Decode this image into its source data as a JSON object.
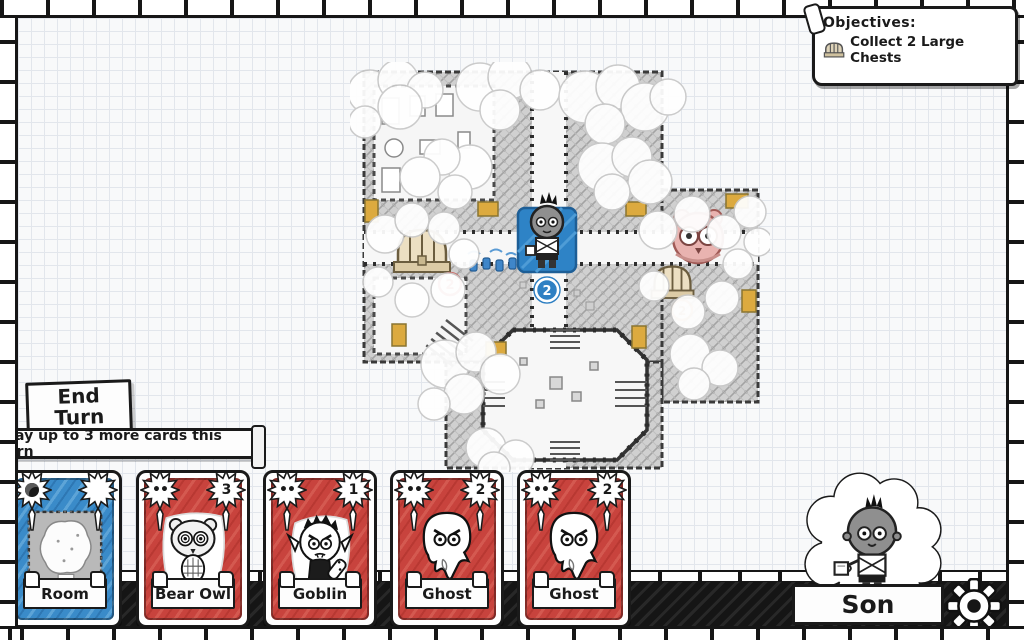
{
  "objectives": {
    "title": "Objectives:",
    "items": [
      {
        "icon": "large-chest-icon",
        "label": "Collect 2 Large Chests"
      }
    ]
  },
  "turn": {
    "end_turn_line1": "End",
    "end_turn_line2": "Turn",
    "banner_text": "Play up to 3 more cards this turn"
  },
  "hand": {
    "cards": [
      {
        "name": "Room",
        "kind": "room",
        "cost": "",
        "color": "#3a8bc9"
      },
      {
        "name": "Bear Owl",
        "kind": "monster",
        "cost": "3",
        "color": "#c8433d"
      },
      {
        "name": "Goblin",
        "kind": "monster",
        "cost": "1",
        "color": "#c8433d"
      },
      {
        "name": "Ghost",
        "kind": "monster",
        "cost": "2",
        "color": "#c8433d"
      },
      {
        "name": "Ghost",
        "kind": "monster",
        "cost": "2",
        "color": "#c8433d"
      }
    ]
  },
  "map": {
    "player_move_badge": "2",
    "left_chest_badge": "2",
    "right_chest_badge": "2"
  },
  "hero": {
    "name": "Son"
  },
  "icons": {
    "monster_attack_dots": "••",
    "objective_chest": "large-chest-icon",
    "settings": "gear-icon"
  },
  "colors": {
    "card_red": "#c8433d",
    "card_blue": "#3a8bc9",
    "tile_highlight_blue": "#2e83c6",
    "door_gold": "#dcaa3f",
    "paper": "#f8f9fa"
  }
}
